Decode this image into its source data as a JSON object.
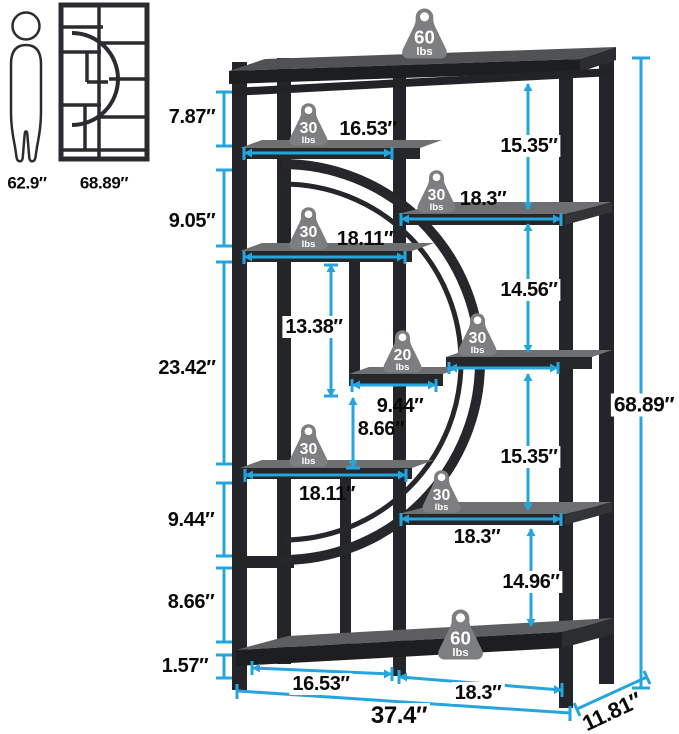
{
  "reference": {
    "person": "62.9″",
    "unit": "68.89″"
  },
  "dims": {
    "left": [
      "7.87″",
      "9.05″",
      "23.42″",
      "9.44″",
      "8.66″",
      "1.57″"
    ],
    "right": [
      "15.35″",
      "14.56″",
      "15.35″",
      "14.96″"
    ],
    "inner": {
      "v1": "13.38″",
      "v2": "8.66″"
    },
    "widths": {
      "l1": "16.53″",
      "r1": "18.3″",
      "l2": "18.11″",
      "m": "9.44″",
      "l3": "18.11″",
      "r2": "18.3″",
      "b1": "16.53″",
      "b2": "18.3″"
    },
    "overall": {
      "height": "68.89″",
      "width": "37.4″",
      "depth": "11.81″"
    }
  },
  "weights": {
    "top_shelf": {
      "value": "60",
      "unit": "lbs"
    },
    "shelf_l1": {
      "value": "30",
      "unit": "lbs"
    },
    "shelf_r1": {
      "value": "30",
      "unit": "lbs"
    },
    "shelf_l2": {
      "value": "30",
      "unit": "lbs"
    },
    "shelf_mr": {
      "value": "30",
      "unit": "lbs"
    },
    "shelf_m": {
      "value": "20",
      "unit": "lbs"
    },
    "shelf_l3": {
      "value": "30",
      "unit": "lbs"
    },
    "shelf_r2": {
      "value": "30",
      "unit": "lbs"
    },
    "bottom_shelf": {
      "value": "60",
      "unit": "lbs"
    }
  },
  "colors": {
    "accent": "#25a5de",
    "frame": "#242528",
    "badge": "#7d7e80"
  }
}
